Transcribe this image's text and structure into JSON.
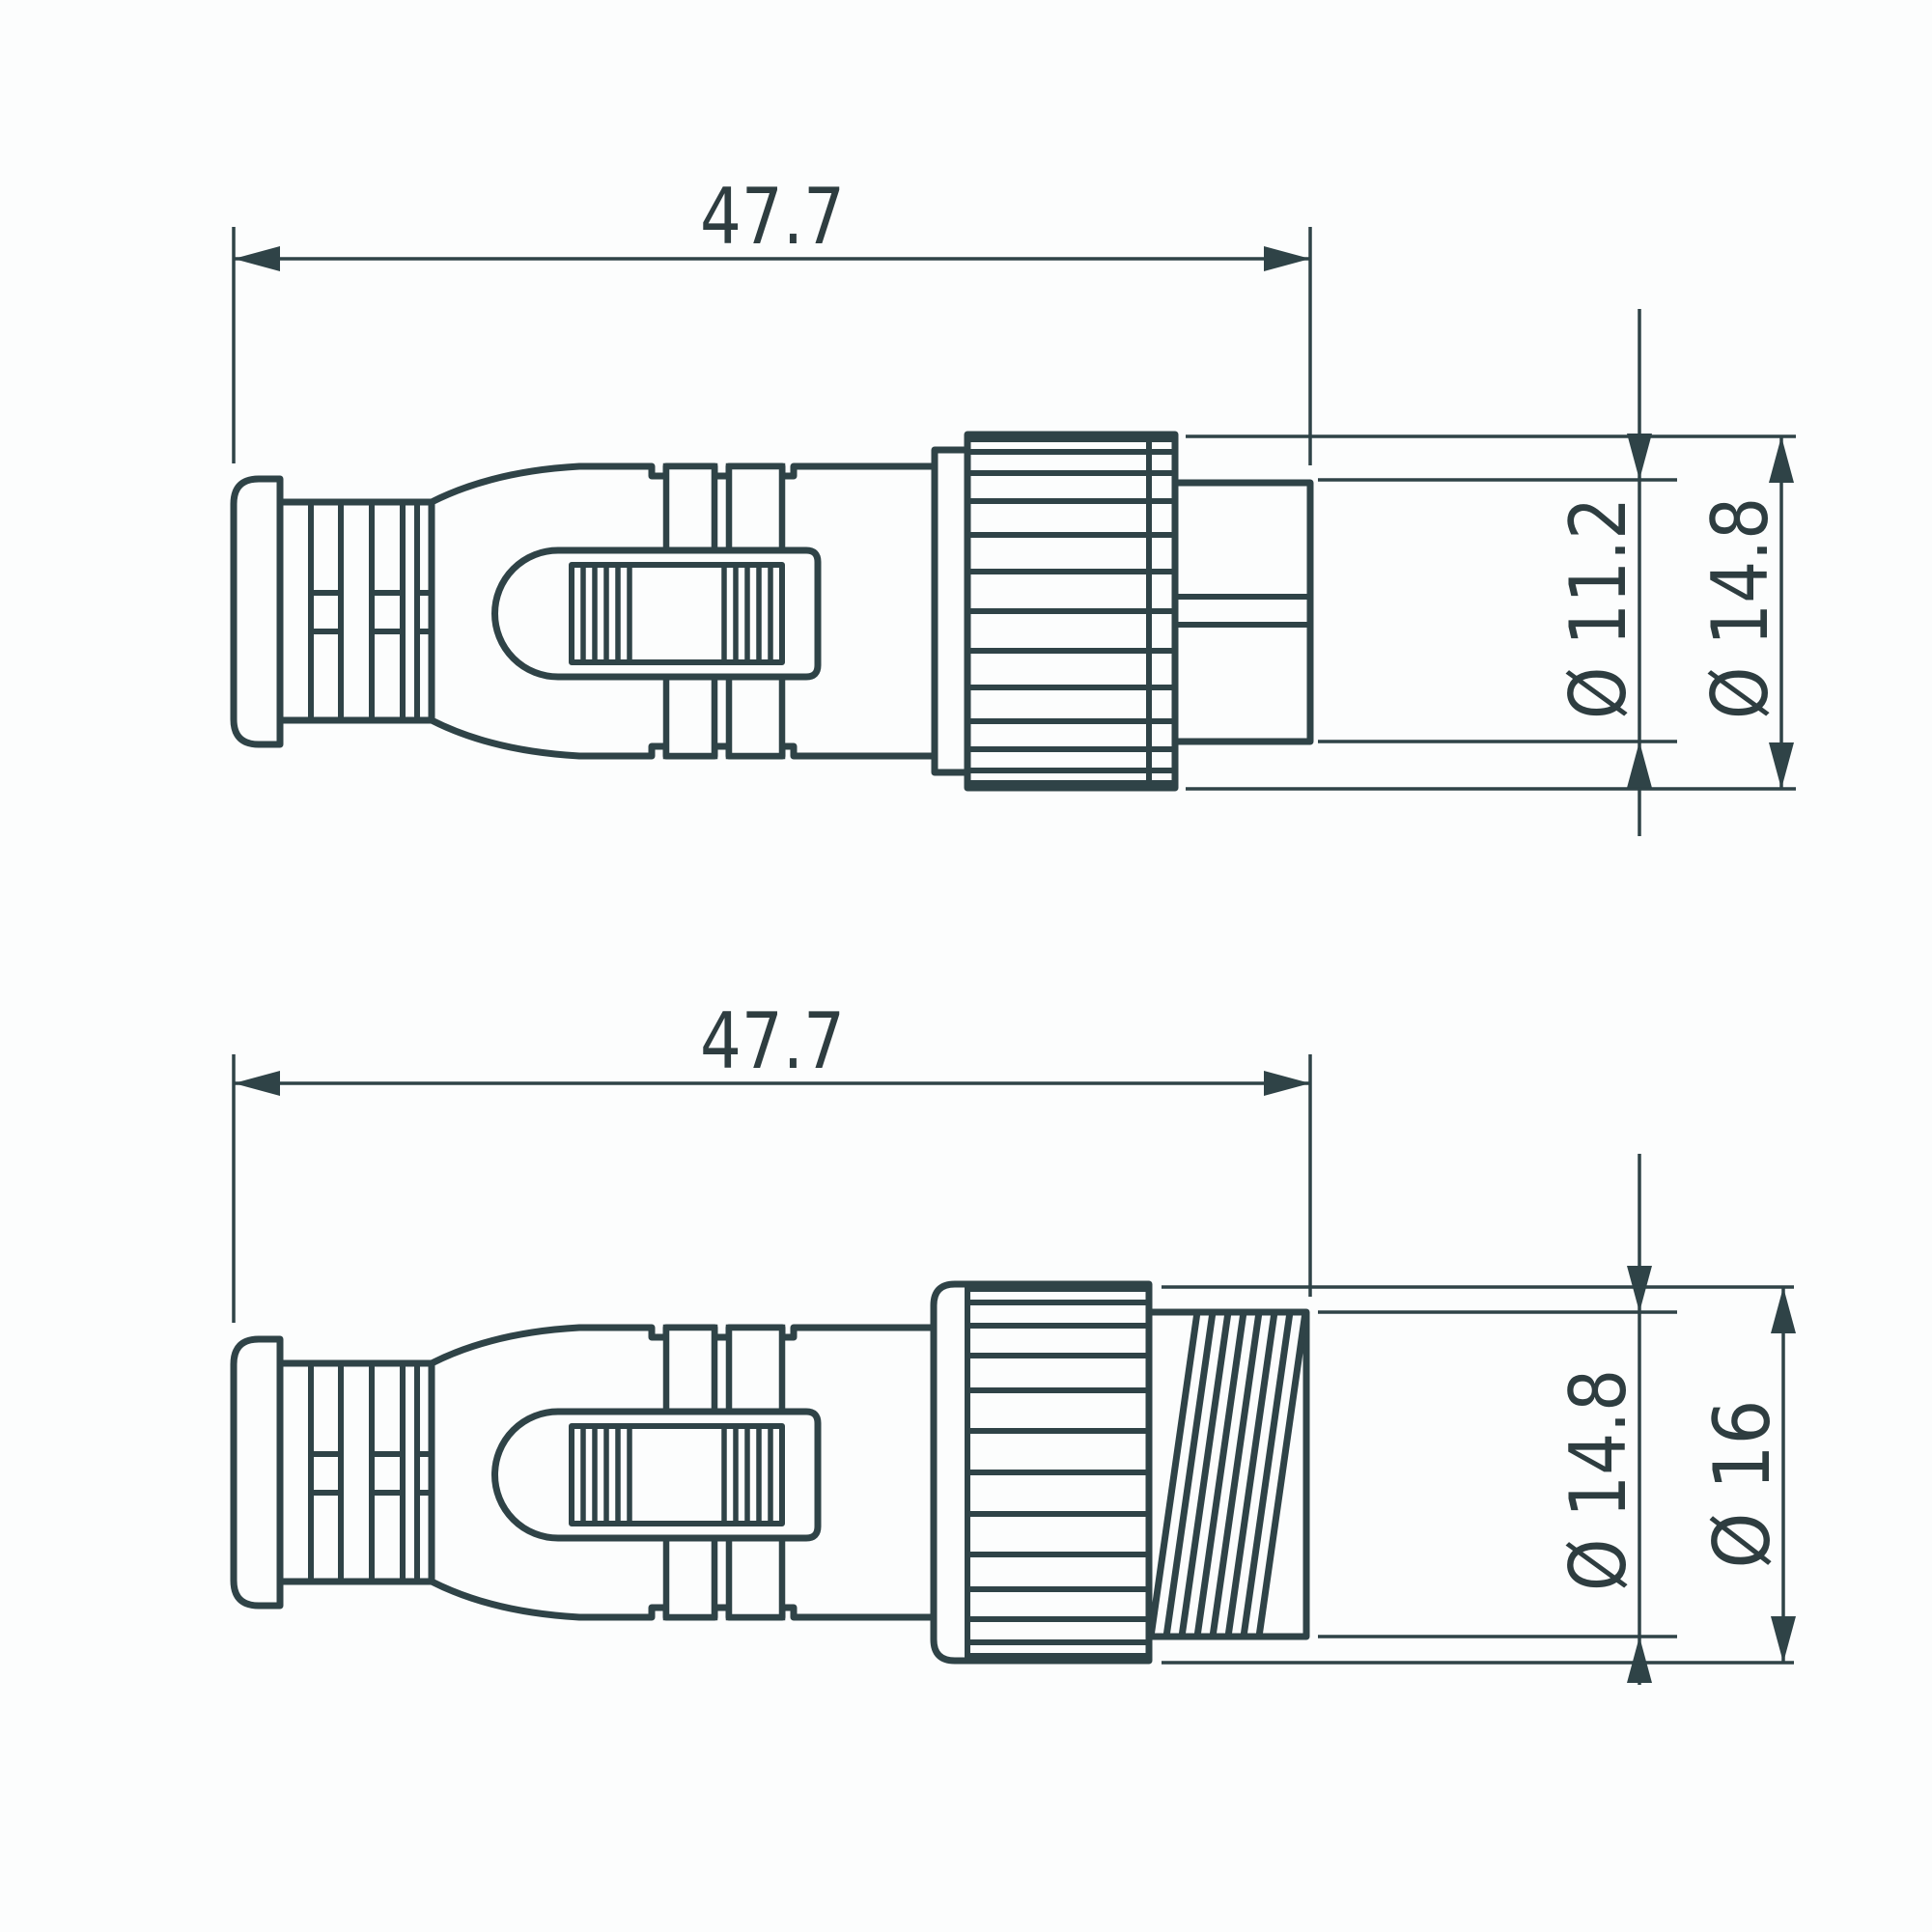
{
  "drawing": {
    "kind": "connector-dimension-drawing",
    "background": "#fcfdfd",
    "line_color": "#2f4347",
    "text_color": "#2e3d40",
    "views": [
      {
        "name": "male-plug-side-view",
        "length": "47.7",
        "diameters": [
          "Ø 11.2",
          "Ø 14.8"
        ]
      },
      {
        "name": "female-socket-side-view",
        "length": "47.7",
        "diameters": [
          "Ø 14.8",
          "Ø 16"
        ]
      }
    ]
  }
}
